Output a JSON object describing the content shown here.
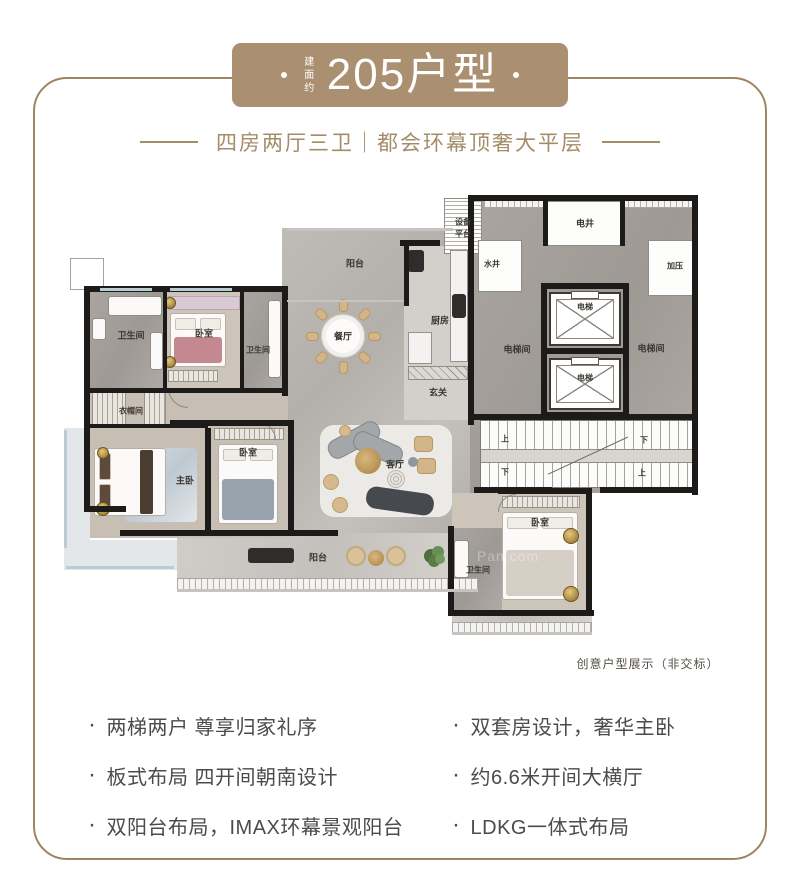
{
  "banner": {
    "area_prefix": "建面约",
    "title": "205户型",
    "dot": "·"
  },
  "subtitle": "四房两厅三卫｜都会环幕顶奢大平层",
  "caption": "创意户型展示（非交标）",
  "watermark": "Pan.com",
  "features": {
    "bullet": "·",
    "left": [
      "两梯两户 尊享归家礼序",
      "板式布局 四开间朝南设计",
      "双阳台布局，IMAX环幕景观阳台"
    ],
    "right": [
      "双套房设计，奢华主卧",
      "约6.6米开间大横厅",
      "LDKG一体式布局"
    ]
  },
  "colors": {
    "banner_gold": "#aa9070",
    "frame_gold": "#9c8464",
    "subtitle_gold": "#a58c69",
    "feature_text": "#4b4b4b",
    "caption_text": "#554f48",
    "wall": "#1c1b19",
    "floor": "#bab6b2"
  },
  "floorplan": {
    "regions": [
      [
        "floor-marble",
        282,
        228,
        196,
        310
      ],
      [
        "floor-balcony",
        177,
        533,
        301,
        59
      ],
      [
        "floor-wood",
        86,
        288,
        200,
        104
      ],
      [
        "floor-marble-dark",
        88,
        292,
        77,
        98
      ],
      [
        "floor-marble-dark",
        243,
        292,
        40,
        98
      ],
      [
        "floor-wood2",
        86,
        388,
        202,
        150
      ],
      [
        "floor-light",
        64,
        428,
        26,
        124
      ],
      [
        "floor-light",
        64,
        540,
        113,
        30
      ],
      [
        "floor-marble-dark",
        470,
        195,
        228,
        298
      ],
      [
        "floor-tile",
        404,
        246,
        66,
        174
      ],
      [
        "floor-wood",
        452,
        493,
        136,
        117
      ],
      [
        "floor-marble-dark",
        452,
        528,
        50,
        82
      ],
      [
        "floor-balcony",
        452,
        610,
        140,
        24
      ],
      [
        "hatch-v-fine",
        484,
        196,
        210,
        12
      ],
      [
        "room-white hatch-h",
        444,
        198,
        38,
        56
      ],
      [
        "room-white",
        478,
        240,
        44,
        52
      ],
      [
        "room-white",
        648,
        240,
        50,
        56
      ],
      [
        "room-white",
        546,
        201,
        78,
        45
      ],
      [
        "room-outline",
        70,
        258,
        34,
        32
      ],
      [
        "stairs",
        480,
        420,
        214,
        68
      ],
      [
        "rug-blue",
        125,
        448,
        72,
        74
      ],
      [
        "rug-white",
        320,
        425,
        132,
        92
      ],
      [
        "hatch-v-fine",
        177,
        578,
        301,
        13
      ],
      [
        "hatch-v-fine",
        452,
        622,
        140,
        12
      ]
    ],
    "walls": [
      [
        84,
        286,
        204,
        6
      ],
      [
        84,
        286,
        6,
        226
      ],
      [
        84,
        506,
        42,
        6
      ],
      [
        120,
        530,
        218,
        6
      ],
      [
        282,
        286,
        6,
        110
      ],
      [
        86,
        388,
        200,
        5
      ],
      [
        163,
        292,
        4,
        96
      ],
      [
        240,
        292,
        4,
        96
      ],
      [
        205,
        428,
        6,
        104
      ],
      [
        170,
        420,
        120,
        6
      ],
      [
        288,
        420,
        6,
        112
      ],
      [
        86,
        424,
        122,
        4
      ],
      [
        468,
        195,
        230,
        6
      ],
      [
        692,
        195,
        6,
        300
      ],
      [
        468,
        195,
        6,
        230
      ],
      [
        541,
        283,
        88,
        6
      ],
      [
        541,
        348,
        88,
        6
      ],
      [
        541,
        412,
        88,
        6
      ],
      [
        541,
        283,
        6,
        135
      ],
      [
        623,
        283,
        6,
        135
      ],
      [
        543,
        198,
        5,
        48
      ],
      [
        620,
        198,
        5,
        48
      ],
      [
        468,
        414,
        230,
        6
      ],
      [
        474,
        487,
        78,
        6
      ],
      [
        600,
        487,
        98,
        6
      ],
      [
        448,
        526,
        6,
        90
      ],
      [
        448,
        610,
        146,
        6
      ],
      [
        586,
        490,
        6,
        126
      ],
      [
        498,
        488,
        94,
        6
      ],
      [
        404,
        246,
        5,
        60
      ],
      [
        400,
        240,
        40,
        6
      ]
    ],
    "windows": [
      [
        "window",
        100,
        288,
        52,
        3
      ],
      [
        "window",
        170,
        288,
        62,
        3
      ],
      [
        "window",
        64,
        430,
        3,
        118
      ],
      [
        "window",
        66,
        566,
        108,
        3
      ],
      [
        "window-gray",
        287,
        228,
        166,
        3
      ],
      [
        "window-gray",
        177,
        589,
        301,
        3
      ],
      [
        "window-gray",
        452,
        632,
        140,
        3
      ],
      [
        "window-gray",
        287,
        300,
        117,
        2
      ]
    ],
    "furniture": [
      {
        "t": "bed",
        "x": 170,
        "y": 313,
        "w": 56,
        "h": 54,
        "dir": "v",
        "blanket": "#c48891"
      },
      {
        "t": "bed",
        "x": 94,
        "y": 448,
        "w": 72,
        "h": 68,
        "dir": "h",
        "blanket": "#fbfaf8",
        "pillow": "#5d4a3a"
      },
      {
        "t": "bed",
        "x": 218,
        "y": 444,
        "w": 60,
        "h": 80,
        "dir": "v",
        "blanket": "#97a3ad"
      },
      {
        "t": "bed",
        "x": 502,
        "y": 512,
        "w": 76,
        "h": 88,
        "dir": "v",
        "blanket": "#d5cfc6"
      },
      {
        "t": "rect",
        "cls": "wardrobe-pink",
        "x": 168,
        "y": 296,
        "w": 72,
        "h": 14
      },
      {
        "t": "rect",
        "cls": "hatch-v",
        "x": 92,
        "y": 390,
        "w": 34,
        "h": 36
      },
      {
        "t": "rect",
        "cls": "hatch-v",
        "x": 144,
        "y": 390,
        "w": 22,
        "h": 36
      },
      {
        "t": "rect",
        "cls": "hatch-v",
        "x": 214,
        "y": 428,
        "w": 70,
        "h": 12
      },
      {
        "t": "rect",
        "cls": "hatch-v",
        "x": 502,
        "y": 496,
        "w": 78,
        "h": 12
      },
      {
        "t": "rect",
        "cls": "hatch-v",
        "x": 168,
        "y": 370,
        "w": 50,
        "h": 12
      },
      {
        "t": "rect",
        "cls": "hatch-d",
        "x": 408,
        "y": 366,
        "w": 60,
        "h": 14
      },
      {
        "t": "rect",
        "cls": "fixture",
        "x": 108,
        "y": 296,
        "w": 54,
        "h": 20
      },
      {
        "t": "rect",
        "cls": "fixture",
        "x": 150,
        "y": 332,
        "w": 13,
        "h": 38
      },
      {
        "t": "rect",
        "cls": "fixture",
        "x": 92,
        "y": 318,
        "w": 14,
        "h": 22
      },
      {
        "t": "rect",
        "cls": "fixture",
        "x": 268,
        "y": 300,
        "w": 13,
        "h": 78
      },
      {
        "t": "rect",
        "cls": "fixture",
        "x": 454,
        "y": 540,
        "w": 15,
        "h": 38
      },
      {
        "t": "rect",
        "cls": "counter",
        "x": 450,
        "y": 250,
        "w": 18,
        "h": 112
      },
      {
        "t": "rect",
        "cls": "dark",
        "x": 452,
        "y": 294,
        "w": 14,
        "h": 24
      },
      {
        "t": "rect",
        "cls": "dark",
        "x": 408,
        "y": 250,
        "w": 16,
        "h": 22
      },
      {
        "t": "rect",
        "cls": "counter",
        "x": 408,
        "y": 332,
        "w": 24,
        "h": 32
      },
      {
        "t": "rect",
        "cls": "runner",
        "x": 140,
        "y": 450,
        "w": 13,
        "h": 64
      },
      {
        "t": "rect",
        "cls": "dark",
        "x": 248,
        "y": 548,
        "w": 46,
        "h": 15
      },
      {
        "t": "rect",
        "cls": "sofa-gray",
        "x": 326,
        "y": 430,
        "w": 56,
        "h": 20,
        "rot": -28
      },
      {
        "t": "rect",
        "cls": "sofa-gray",
        "x": 352,
        "y": 438,
        "w": 52,
        "h": 20,
        "rot": 24
      },
      {
        "t": "rect",
        "cls": "sofa-dark",
        "x": 366,
        "y": 490,
        "w": 68,
        "h": 22,
        "rot": 8
      },
      {
        "t": "rect",
        "cls": "chair-beige",
        "x": 414,
        "y": 436,
        "w": 19,
        "h": 16
      },
      {
        "t": "rect",
        "cls": "chair-beige",
        "x": 417,
        "y": 458,
        "w": 19,
        "h": 16
      },
      {
        "t": "circle",
        "cls": "gold-table",
        "cx": 368,
        "cy": 461,
        "r": 13
      },
      {
        "t": "circle",
        "cls": "pouf",
        "cx": 331,
        "cy": 482,
        "r": 8
      },
      {
        "t": "circle",
        "cls": "pouf",
        "cx": 340,
        "cy": 505,
        "r": 8
      },
      {
        "t": "circle",
        "cls": "pouf",
        "cx": 345,
        "cy": 431,
        "r": 6
      },
      {
        "t": "circle",
        "cls": "pouf-pattern",
        "cx": 396,
        "cy": 479,
        "r": 9
      },
      {
        "t": "circle",
        "cls": "dot-gray",
        "cx": 413,
        "cy": 462,
        "r": 5
      },
      {
        "t": "circle",
        "cls": "rattan",
        "cx": 356,
        "cy": 556,
        "r": 10
      },
      {
        "t": "circle",
        "cls": "rattan",
        "cx": 396,
        "cy": 556,
        "r": 10
      },
      {
        "t": "circle",
        "cls": "gold-table",
        "cx": 376,
        "cy": 558,
        "r": 8
      },
      {
        "t": "circle",
        "cls": "medal",
        "cx": 103,
        "cy": 509,
        "r": 7
      },
      {
        "t": "circle",
        "cls": "medal",
        "cx": 103,
        "cy": 453,
        "r": 6
      },
      {
        "t": "circle",
        "cls": "medal",
        "cx": 571,
        "cy": 536,
        "r": 8
      },
      {
        "t": "circle",
        "cls": "medal",
        "cx": 571,
        "cy": 594,
        "r": 8
      },
      {
        "t": "circle",
        "cls": "medal",
        "cx": 170,
        "cy": 303,
        "r": 6
      },
      {
        "t": "circle",
        "cls": "medal",
        "cx": 170,
        "cy": 362,
        "r": 6
      },
      {
        "t": "dining",
        "cx": 343,
        "cy": 336,
        "r": 22
      },
      {
        "t": "elevator",
        "x": 549,
        "y": 292,
        "w": 72,
        "h": 54
      },
      {
        "t": "elevator",
        "x": 549,
        "y": 358,
        "w": 72,
        "h": 52
      },
      {
        "t": "plant",
        "cx": 435,
        "cy": 557,
        "r": 11
      },
      {
        "t": "arc",
        "x": 168,
        "y": 388,
        "r": 20,
        "rot": 0
      },
      {
        "t": "arc",
        "x": 258,
        "y": 422,
        "r": 18,
        "rot": 180
      },
      {
        "t": "arc",
        "x": 498,
        "y": 494,
        "r": 18,
        "rot": 90
      }
    ],
    "labels": [
      [
        "卫生间",
        131,
        335
      ],
      [
        "卧室",
        204,
        333
      ],
      [
        "卫生间",
        258,
        350,
        8
      ],
      [
        "阳台",
        355,
        263
      ],
      [
        "餐厅",
        343,
        336
      ],
      [
        "厨房",
        440,
        320
      ],
      [
        "玄关",
        438,
        392
      ],
      [
        "衣帽间",
        131,
        411,
        8
      ],
      [
        "主卧",
        185,
        480
      ],
      [
        "卧室",
        248,
        452
      ],
      [
        "客厅",
        395,
        464
      ],
      [
        "阳台",
        318,
        557
      ],
      [
        "设备",
        463,
        222,
        8
      ],
      [
        "平台",
        463,
        234,
        8
      ],
      [
        "水井",
        492,
        264,
        8
      ],
      [
        "电井",
        585,
        223
      ],
      [
        "加压",
        675,
        266,
        8
      ],
      [
        "电梯间",
        517,
        349
      ],
      [
        "电梯",
        585,
        307,
        8
      ],
      [
        "电梯",
        585,
        378,
        8
      ],
      [
        "电梯间",
        651,
        348
      ],
      [
        "上",
        505,
        439,
        8
      ],
      [
        "下",
        505,
        472,
        8
      ],
      [
        "下",
        644,
        440,
        8
      ],
      [
        "上",
        642,
        473,
        8
      ],
      [
        "卧室",
        540,
        522
      ],
      [
        "卫生间",
        478,
        570,
        8
      ]
    ]
  }
}
